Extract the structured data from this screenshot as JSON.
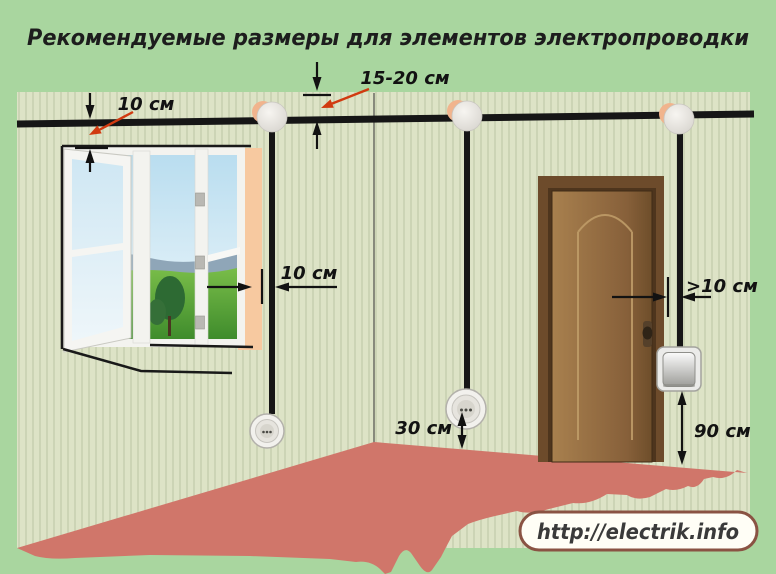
{
  "title": "Рекомендуемые размеры для элементов электропроводки",
  "dimensions": {
    "wire_below_ceiling": "15-20 см",
    "wire_above_window": "10 см",
    "wire_from_window": "10 см",
    "wire_from_door": ">10 см",
    "socket_above_floor": "30 см",
    "switch_above_floor": "90 см"
  },
  "watermark": {
    "url_label": "http://electrik.info"
  },
  "colors": {
    "background_green": "#a9d69f",
    "wall_base": "#dde3c6",
    "wall_stripe": "#ccd4b5",
    "floor_salmon": "#d0766a",
    "wire_black": "#161616",
    "leader_arrow_red": "#d13a10",
    "door_wood": "#8a6238",
    "window_recess_peach": "#f7c9a0",
    "watermark_border": "#8a5343"
  }
}
